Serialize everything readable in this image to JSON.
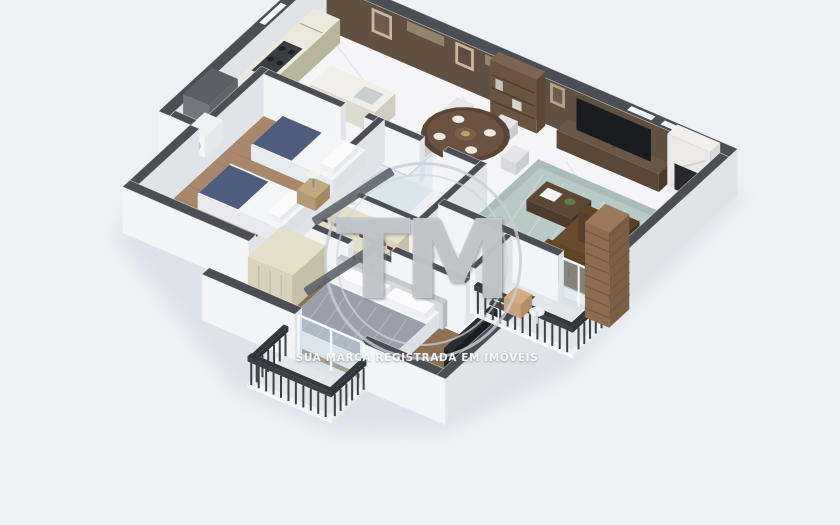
{
  "meta": {
    "kind": "3d-floor-plan-render",
    "projection": "isometric"
  },
  "watermark": {
    "initials": "TM",
    "tagline": "SUA MARCA REGISTRADA EM IMÓVEIS"
  },
  "palette": {
    "background": "#edf0f5",
    "shadow": "#dbe0e8",
    "wallTop": "#4b4f55",
    "wallFace": "#f3f4f6",
    "wallFaceShade": "#e0e3e8",
    "woodWall": "#5f5041",
    "woodWallLight": "#9a8a74",
    "floorMarble": "#f5f5f7",
    "marbleVein": "#e2e4e9",
    "floorWood": "#a9876a",
    "floorWoodDark": "#8e7154",
    "floorTile": "#eef0f3",
    "cabinet": "#c9c5aa",
    "cabinetTop": "#eceade",
    "cream": "#d8d2bb",
    "fridge": "#72777d",
    "fridgeTop": "#5b6066",
    "navy": "#4e5d7d",
    "mattress": "#f4f5f7",
    "duvet": "#99a0ab",
    "sofa": "#5e4327",
    "sofaDark": "#533b22",
    "rug": "#a9bcb8",
    "rugLight": "#b9cac6",
    "tableWood": "#5b4433",
    "walnut": "#5a4736",
    "brick": "#8d6c50",
    "brickLine": "#73543e",
    "railing": "#3c4046",
    "railTop": "#34383d",
    "glass": "rgba(203,223,236,0.42)",
    "balconyFloor": "#e4e7ea",
    "tv": "#191b1e"
  },
  "rooms": [
    {
      "name": "kitchen",
      "furniture": [
        "cabinets",
        "stove",
        "fridge",
        "peninsula-counter"
      ]
    },
    {
      "name": "laundry-nook",
      "furniture": [
        "washing-machine"
      ]
    },
    {
      "name": "dining-area",
      "furniture": [
        "round-table",
        "chairs",
        "shelf-unit"
      ]
    },
    {
      "name": "living-room",
      "furniture": [
        "tv-wall-unit",
        "fireplace",
        "rug",
        "coffee-table",
        "sofa"
      ]
    },
    {
      "name": "bedroom-1",
      "furniture": [
        "twin-bed",
        "twin-bed",
        "nightstand",
        "lamp"
      ]
    },
    {
      "name": "bathroom-1",
      "furniture": [
        "shower",
        "toilet",
        "vanity"
      ]
    },
    {
      "name": "walk-in-closet",
      "furniture": [
        "wardrobe",
        "wardrobe"
      ]
    },
    {
      "name": "bathroom-2",
      "furniture": [
        "bathtub",
        "toilet",
        "vanity"
      ]
    },
    {
      "name": "master-bedroom",
      "furniture": [
        "double-bed",
        "wardrobe",
        "tv-panel"
      ]
    },
    {
      "name": "balcony-east",
      "furniture": [
        "armchair",
        "side-table",
        "brick-column"
      ]
    },
    {
      "name": "balcony-south",
      "furniture": []
    }
  ]
}
